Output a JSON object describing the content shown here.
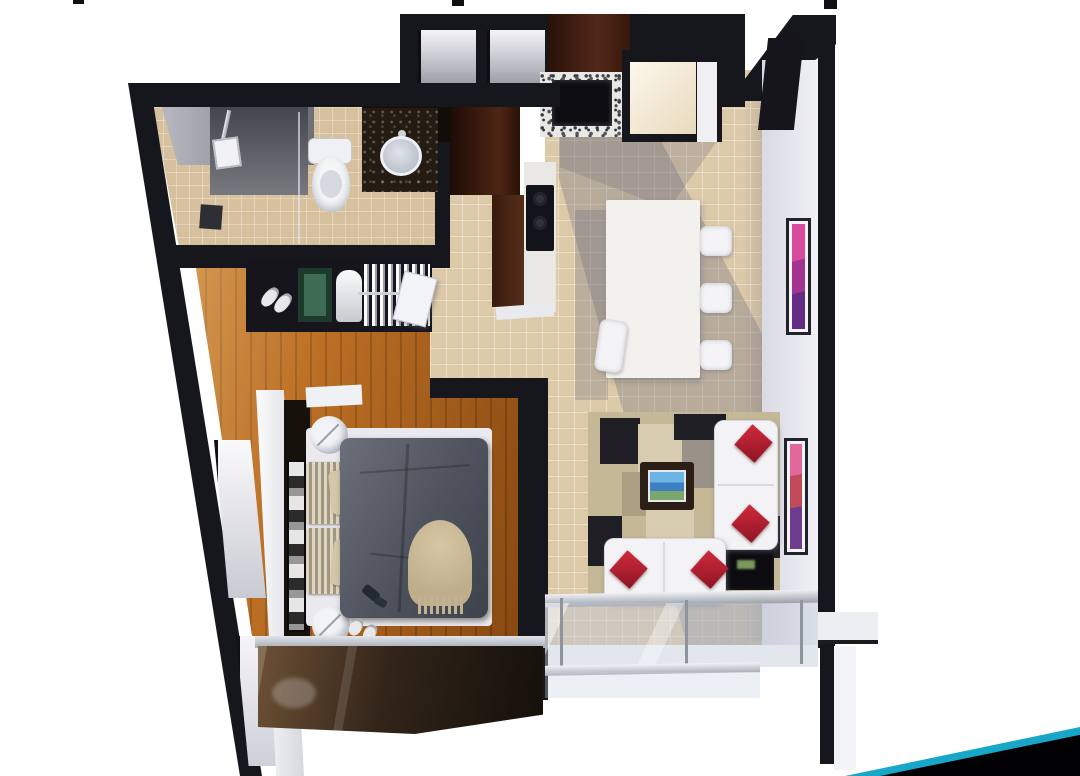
{
  "scene": {
    "type": "3d-floor-plan-render",
    "description": "Top-down 3D rendering of a one-bedroom apartment unit on a white background, slide-style page with a teal-and-black corner ribbon",
    "rooms": [
      {
        "name": "bathroom",
        "floor": "beige-tile",
        "fixtures": [
          "shower-head",
          "shower-glass",
          "floor-drain",
          "toilet",
          "vanity-dark-granite",
          "oval-sink"
        ]
      },
      {
        "name": "closet",
        "items": [
          "slippers",
          "green-storage-box",
          "laundry-basket",
          "hanging-white-clothes"
        ]
      },
      {
        "name": "bedroom",
        "floor": "wood-plank",
        "furniture": [
          "bed-gray-duvet",
          "striped-pillows",
          "tan-throw-blanket",
          "round-side-table-x2",
          "headboard-art-panel",
          "slippers",
          "window-glass-wall"
        ]
      },
      {
        "name": "kitchen",
        "furniture": [
          "brown-tall-cabinet",
          "granite-counter",
          "black-cooktop",
          "coffee-machine",
          "refrigerator"
        ]
      },
      {
        "name": "dining",
        "floor": "beige-tile",
        "furniture": [
          "granite-top-table",
          "white-chairs-x4"
        ]
      },
      {
        "name": "living-room",
        "furniture": [
          "geometric-rug",
          "white-l-sofa",
          "red-pillows-x4",
          "coffee-table-tv",
          "black-tv-cabinet",
          "wall-art-x2"
        ]
      },
      {
        "name": "balcony",
        "features": [
          "glass-railing",
          "metal-rails",
          "glass-posts"
        ]
      }
    ],
    "palette": {
      "wall_dark": "#16161d",
      "tile_floor": "#dcc9a8",
      "wood_floor": "#b06218",
      "duvet_gray": "#545861",
      "pillow_red": "#b5202f",
      "rug_black": "#1e1e24",
      "rug_beige": "#c5b897",
      "accent_teal": "#18a7c9",
      "corner_black": "#010103",
      "right_wall_white": "#e8e9f0",
      "art_purple": "#a3348f",
      "art_red": "#c14a58"
    },
    "cropped_text_marks": 3
  }
}
